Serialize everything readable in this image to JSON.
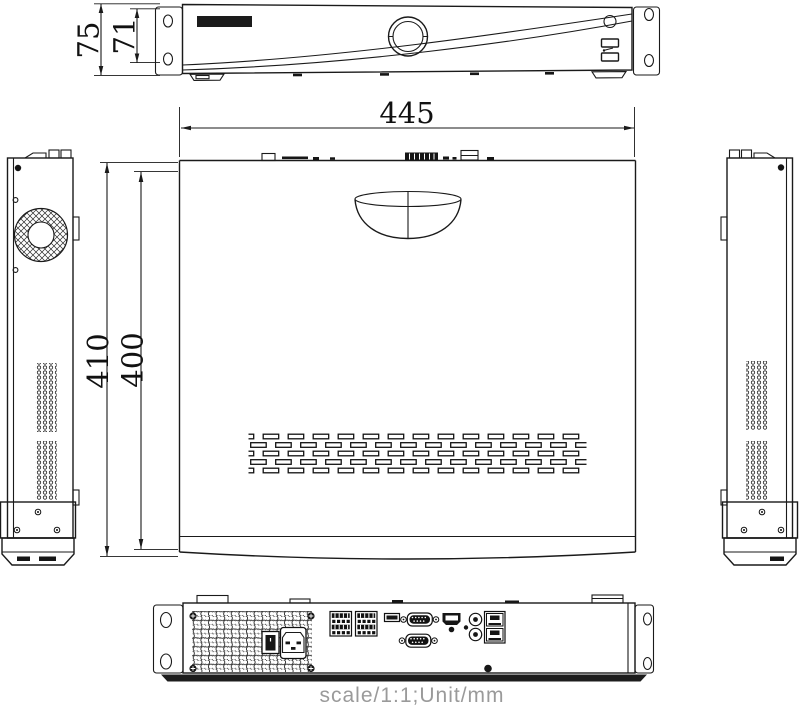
{
  "drawing": {
    "dimensions": {
      "width_mm": "445",
      "depth_overall_mm": "410",
      "depth_body_mm": "400",
      "height_overall_mm": "75",
      "height_body_mm": "71"
    },
    "scale_note": "scale/1:1;Unit/mm",
    "colors": {
      "line": "#1a1a1a",
      "dimension_text": "#111111",
      "note_text": "#9a9a9a",
      "background": "#ffffff",
      "dark_fill": "#161616"
    }
  }
}
